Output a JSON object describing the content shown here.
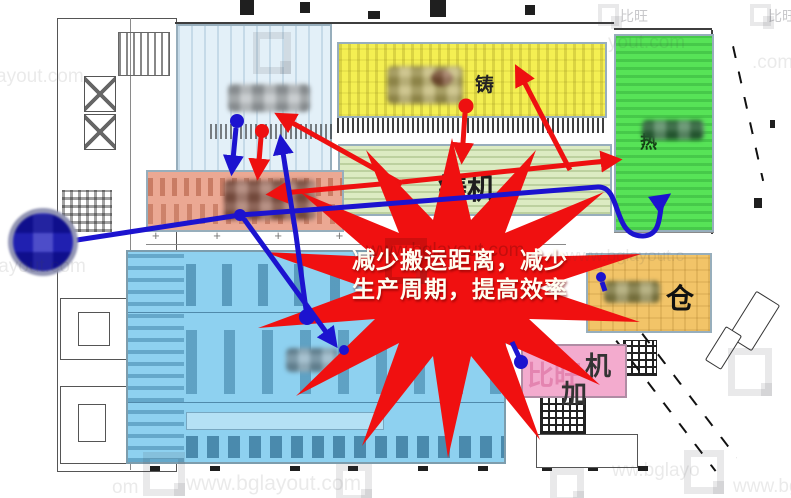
{
  "callout": {
    "line1": "减少搬运距离，减少",
    "line2": "生产周期，提高效率",
    "burst_color": "#f01010",
    "text_color": "#fffef2"
  },
  "zones": {
    "yellow_casting": {
      "label": "铸",
      "color": "#f4ef52"
    },
    "green_heat": {
      "label": "热",
      "color": "#57e357"
    },
    "die_cast_band": {
      "label": "铸机",
      "color": "#dcebc2"
    },
    "warehouse": {
      "label": "仓",
      "color": "#f2c468"
    },
    "machining_pink": {
      "char1": "机",
      "char2": "加",
      "ghost": "比旺",
      "color": "#f3abce"
    },
    "top_left_blue": {
      "color": "#e3f0f8"
    },
    "salmon_die_area": {
      "color": "#eba893"
    },
    "stamping_blue": {
      "color": "#8ed1f0"
    }
  },
  "arrows": {
    "red": "#ee1010",
    "blue": "#1c13cf"
  },
  "plan_marks": {
    "cross_row": "+ + + + + + +"
  },
  "watermark": {
    "brand": "比旺",
    "tiles": [
      "ayout.com",
      "yout.com",
      ".com",
      "layout.com",
      "www.bglayout.c",
      "www.bglayout.com",
      "om",
      "ww.bglayo",
      "www.bglayou",
      "www.bglayout.com"
    ]
  }
}
